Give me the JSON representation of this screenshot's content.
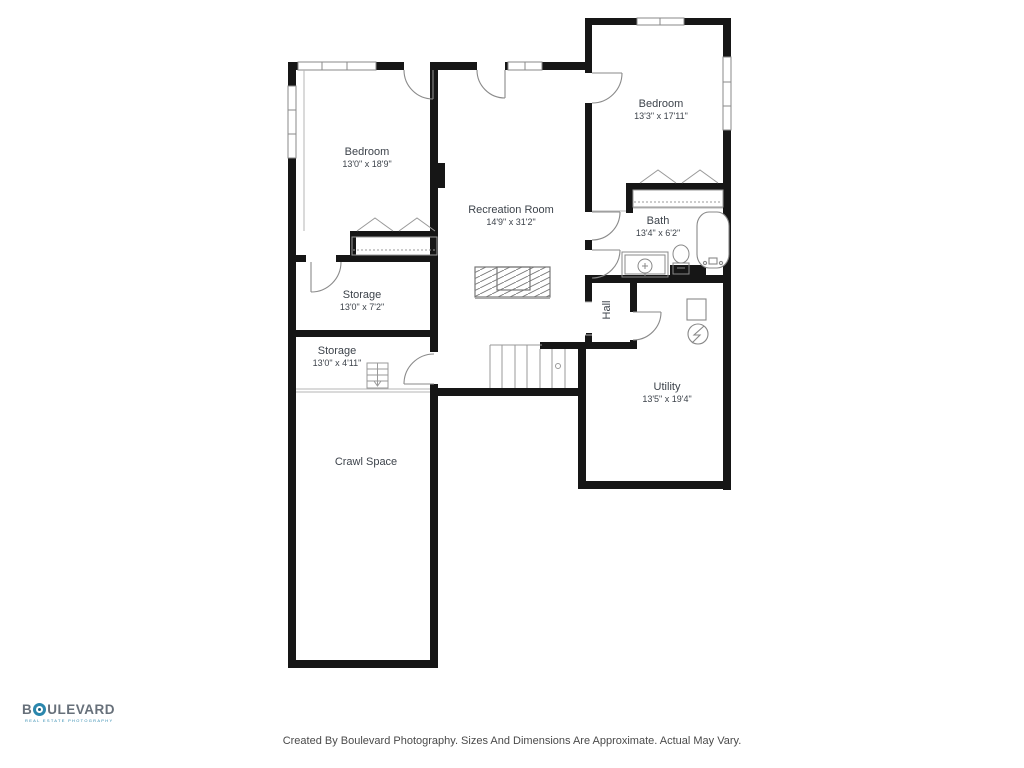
{
  "rooms": {
    "bedroom_left": {
      "name": "Bedroom",
      "dims": "13'0\" x 18'9\""
    },
    "bedroom_right": {
      "name": "Bedroom",
      "dims": "13'3\" x 17'11\""
    },
    "recreation": {
      "name": "Recreation Room",
      "dims": "14'9\" x 31'2\""
    },
    "bath": {
      "name": "Bath",
      "dims": "13'4\" x 6'2\""
    },
    "hall": {
      "name": "Hall"
    },
    "storage_upper": {
      "name": "Storage",
      "dims": "13'0\" x 7'2\""
    },
    "storage_lower": {
      "name": "Storage",
      "dims": "13'0\" x 4'11\""
    },
    "utility": {
      "name": "Utility",
      "dims": "13'5\" x 19'4\""
    },
    "crawl_space": {
      "name": "Crawl Space"
    }
  },
  "footer": {
    "text": "Created By Boulevard Photography. Sizes And Dimensions Are Approximate. Actual May Vary."
  },
  "logo": {
    "prefix": "B",
    "suffix": "ULEVARD",
    "tagline": "REAL ESTATE PHOTOGRAPHY"
  },
  "colors": {
    "wall": "#161616",
    "line": "#8a8a8a",
    "text": "#3d434b",
    "accent": "#2b87ad"
  }
}
